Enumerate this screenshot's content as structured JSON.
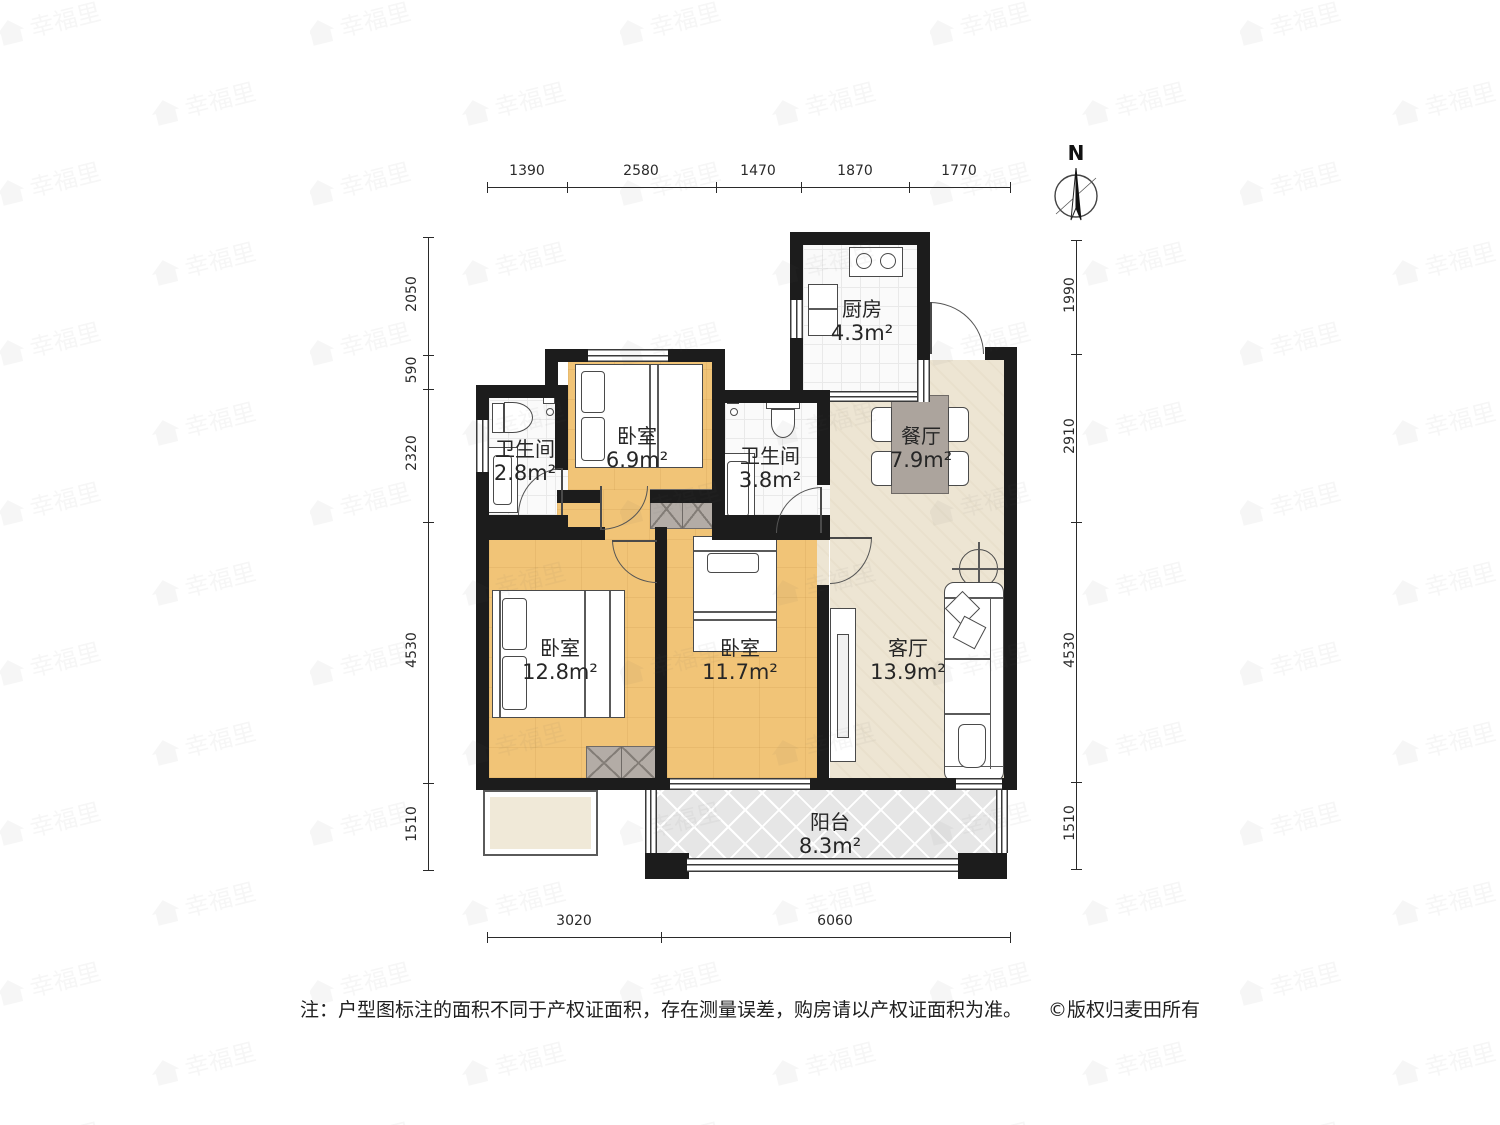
{
  "compass": {
    "label": "N"
  },
  "watermark": {
    "text": "幸福里"
  },
  "rooms": [
    {
      "id": "kitchen",
      "name": "厨房",
      "area": "4.3m²"
    },
    {
      "id": "dining",
      "name": "餐厅",
      "area": "7.9m²"
    },
    {
      "id": "bath-left",
      "name": "卫生间",
      "area": "2.8m²"
    },
    {
      "id": "bedroom-small",
      "name": "卧室",
      "area": "6.9m²"
    },
    {
      "id": "bath-right",
      "name": "卫生间",
      "area": "3.8m²"
    },
    {
      "id": "bedroom-master",
      "name": "卧室",
      "area": "12.8m²"
    },
    {
      "id": "bedroom-middle",
      "name": "卧室",
      "area": "11.7m²"
    },
    {
      "id": "living",
      "name": "客厅",
      "area": "13.9m²"
    },
    {
      "id": "balcony",
      "name": "阳台",
      "area": "8.3m²"
    }
  ],
  "dimensions": {
    "top": [
      "1390",
      "2580",
      "1470",
      "1870",
      "1770"
    ],
    "left": [
      "2050",
      "590",
      "2320",
      "4530",
      "1510"
    ],
    "right": [
      "1990",
      "2910",
      "4530",
      "1510"
    ],
    "bottom": [
      "3020",
      "6060"
    ]
  },
  "footer": {
    "note": "注：户型图标注的面积不同于产权证面积，存在测量误差，购房请以产权证面积为准。",
    "copyright": "©版权归麦田所有"
  },
  "colors": {
    "wall": "#1c1c1c",
    "wood_floor": "#F1C477",
    "tile_floor": "#fafafa",
    "beige_floor": "#EDE5D3",
    "balcony_floor": "#E6E6E6",
    "wardrobe": "#B3ACA6",
    "table": "#ACA49D",
    "text": "#262626"
  }
}
